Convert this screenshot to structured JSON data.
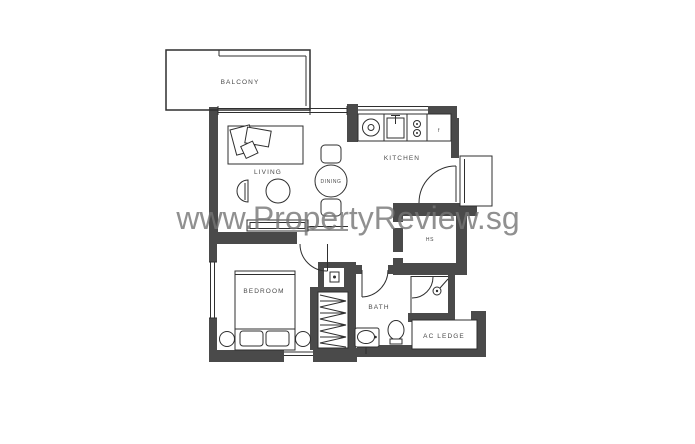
{
  "watermark": {
    "text": "www.PropertyReview.sg",
    "color": "#757575"
  },
  "rooms": {
    "balcony": "BALCONY",
    "living": "LIVING",
    "dining": "DINING",
    "kitchen": "KITCHEN",
    "household_shelter": "HS",
    "bedroom": "BEDROOM",
    "bath": "BATH",
    "ac_ledge": "AC LEDGE"
  },
  "appliances": {
    "fridge": "f"
  },
  "colors": {
    "wall": "#4a4a4a",
    "line": "#2f2f2f",
    "background": "#ffffff",
    "watermark": "#757575"
  }
}
